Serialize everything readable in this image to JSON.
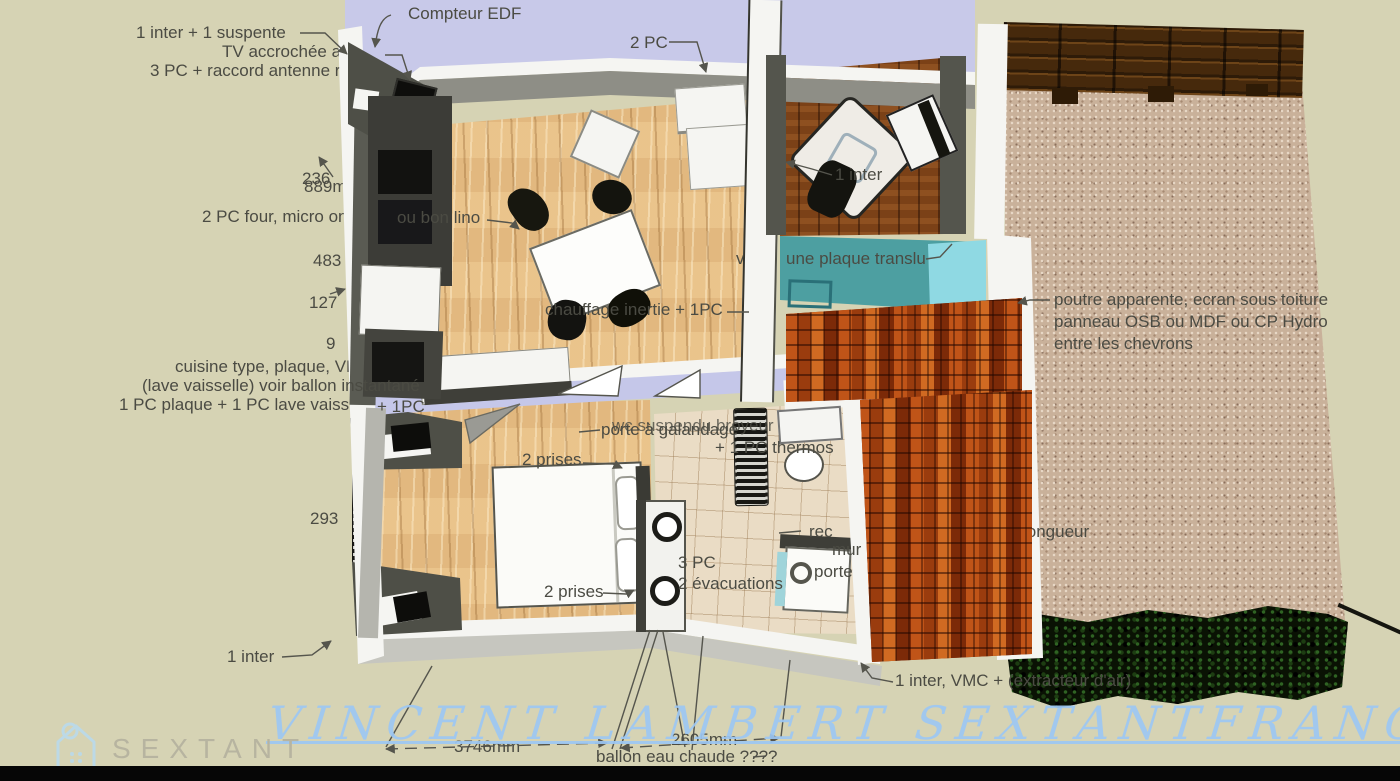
{
  "watermark": {
    "text": "VINCENT LAMBERT SEXTANTFRANCE"
  },
  "logo": {
    "brand": "SEXTANT"
  },
  "annotations": {
    "top_left_1": "1 inter + 1 suspente",
    "top_left_2": "TV accrochée au",
    "top_left_3": "3 PC + raccord antenne r",
    "compteur": "Compteur EDF",
    "pc2_top": "2 PC",
    "kitchen_left": "2 PC four, micro onde",
    "kitchen_right": "ou bon lino",
    "cuisine_1": "cuisine type, plaque, VMC h",
    "cuisine_2": "(lave vaisselle) voir ballon instantané",
    "cuisine_3": "1 PC plaque + 1 PC lave vaiss",
    "cuisine_3b": "+ 1PC",
    "chauffage": "chauffage inertie + 1PC",
    "inter_office": "1 inter",
    "plaque_1": "voir",
    "plaque_2": "une plaque translu",
    "bardage": "bardage norvegien",
    "poutre_1": "poutre apparente, ecran sous toiture",
    "poutre_2": "panneau OSB ou MDF ou CP Hydro",
    "poutre_3": "entre les chevrons",
    "wc": "wc suspendu broyeur",
    "galandage": "porte à galandage",
    "thermos": "+ 1 PC thermos",
    "prises_top": "2 prises",
    "prises_bottom": "2 prises",
    "pc3": "3 PC",
    "evacuations": "2 évacuations",
    "recul_1": "rec",
    "recul_2": "mur",
    "recul_3": "porte",
    "longueur": "longueur",
    "inter_bottom": "1 inter",
    "inter_vmc": "1 inter, VMC + (extracteur d'air)",
    "ballon": "ballon eau chaude ????"
  },
  "dimensions": {
    "d236": "236",
    "d889": "889mm",
    "d483": "483",
    "d127": "127",
    "d9": "9",
    "d293": "293",
    "d3746": "3746mm",
    "d2605": "2605mm"
  },
  "colors": {
    "background": "#d6d3b4",
    "roof_lavender": "#c8c9e9",
    "teal_glass": "#4d9fa1",
    "brick": "#93350f",
    "annotation_text": "#4b4b43",
    "watermark_blue": "#9cc7f3",
    "logo_text": "#b7b4a0",
    "logo_icon": "#bcd9e6"
  }
}
